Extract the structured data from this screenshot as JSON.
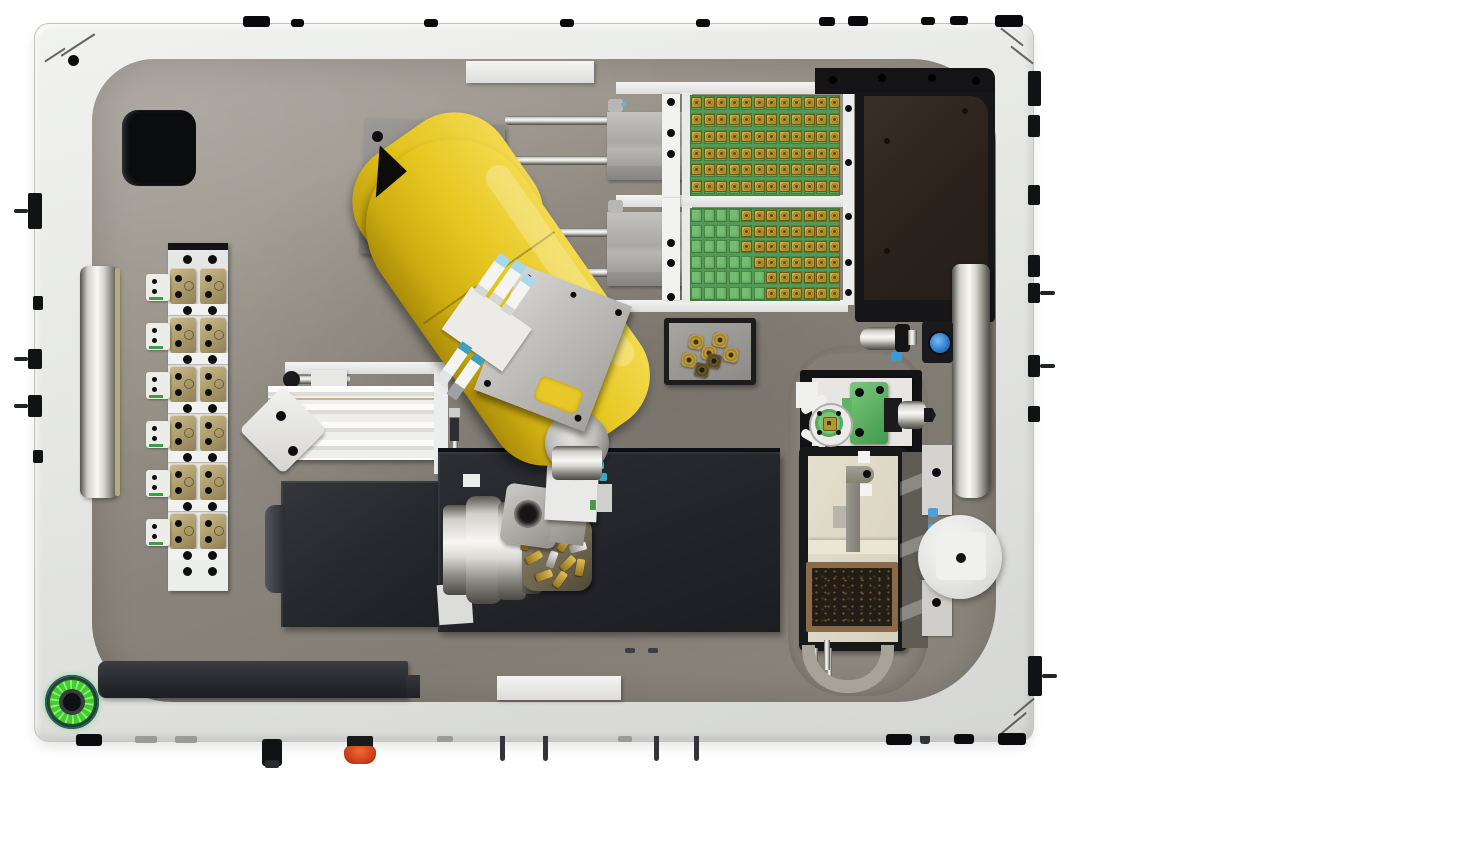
{
  "palette": {
    "background": "#ffffff",
    "frame": "#e9eae8",
    "deck": "#948f87",
    "deck_light": "#a7a29b",
    "deck_dark": "#7e7970",
    "robot_yellow": "#e6c41d",
    "robot_yellow_light": "#f4dc52",
    "robot_yellow_dark": "#b2930b",
    "tray_green": "#58a158",
    "tray_cell": "#74bd72",
    "chip_gold": "#c7a33e",
    "charcoal": "#26282c",
    "dark_brown": "#2f2620",
    "tan_module": "#b4a478",
    "cream": "#ded8c6",
    "chip_tray_frame": "#8a6a48",
    "chip_tray_fill": "#241d15",
    "led_green": "#4fd437",
    "estop_red": "#d2421f",
    "lens_blue": "#2e7fd0",
    "fitting_blue": "#58aee0",
    "green_fixture": "#5eb364"
  },
  "tool_rack": {
    "rows": 6,
    "columns": 2
  },
  "tray_feeders": {
    "columns": 12,
    "rows": 6,
    "trays": [
      {
        "id": "tray-1",
        "filled_per_row": [
          12,
          12,
          12,
          12,
          12,
          12
        ],
        "fill_align": "left"
      },
      {
        "id": "tray-2",
        "filled_per_row": [
          8,
          8,
          8,
          7,
          6,
          6
        ],
        "fill_align": "right"
      }
    ]
  },
  "parts_tray": {
    "nuts": [
      {
        "x": 20,
        "y": 12,
        "dark": false
      },
      {
        "x": 44,
        "y": 10,
        "dark": false
      },
      {
        "x": 33,
        "y": 23,
        "dark": false
      },
      {
        "x": 13,
        "y": 30,
        "dark": false
      },
      {
        "x": 38,
        "y": 31,
        "dark": true
      },
      {
        "x": 55,
        "y": 25,
        "dark": false
      },
      {
        "x": 26,
        "y": 40,
        "dark": true
      }
    ]
  },
  "tool_turret": {
    "bits": [
      {
        "dx": -20,
        "dy": -30,
        "rot": 40,
        "kind": "gold"
      },
      {
        "dx": 0,
        "dy": -32,
        "rot": 10,
        "kind": "gold"
      },
      {
        "dx": 16,
        "dy": -24,
        "rot": 65,
        "kind": "gold"
      },
      {
        "dx": -30,
        "dy": -12,
        "rot": 15,
        "kind": "gold"
      },
      {
        "dx": -10,
        "dy": -14,
        "rot": 50,
        "kind": "gold"
      },
      {
        "dx": 8,
        "dy": -10,
        "rot": 30,
        "kind": "gold"
      },
      {
        "dx": 22,
        "dy": -6,
        "rot": 75,
        "kind": "silver"
      },
      {
        "dx": -22,
        "dy": 4,
        "rot": 60,
        "kind": "gold"
      },
      {
        "dx": -4,
        "dy": 6,
        "rot": 20,
        "kind": "silver"
      },
      {
        "dx": 12,
        "dy": 10,
        "rot": 45,
        "kind": "gold"
      },
      {
        "dx": 24,
        "dy": 14,
        "rot": 10,
        "kind": "gold"
      },
      {
        "dx": -12,
        "dy": 22,
        "rot": 70,
        "kind": "gold"
      },
      {
        "dx": 4,
        "dy": 26,
        "rot": 35,
        "kind": "gold"
      }
    ]
  },
  "frame_hardware": {
    "top_screws": [
      [
        243,
        16,
        27,
        11
      ],
      [
        291,
        19,
        13,
        8
      ],
      [
        424,
        19,
        14,
        8
      ],
      [
        560,
        19,
        14,
        8
      ],
      [
        696,
        19,
        14,
        8
      ],
      [
        819,
        17,
        16,
        9
      ],
      [
        848,
        16,
        20,
        10
      ],
      [
        921,
        17,
        14,
        8
      ],
      [
        950,
        16,
        18,
        9
      ],
      [
        995,
        15,
        28,
        12
      ]
    ],
    "left_ports": [
      {
        "x": 28,
        "y": 193,
        "w": 14,
        "h": 36,
        "pin": true
      },
      {
        "x": 33,
        "y": 296,
        "w": 10,
        "h": 14,
        "pin": false
      },
      {
        "x": 28,
        "y": 349,
        "w": 14,
        "h": 20,
        "pin": true
      },
      {
        "x": 28,
        "y": 395,
        "w": 14,
        "h": 22,
        "pin": true
      },
      {
        "x": 33,
        "y": 450,
        "w": 10,
        "h": 13,
        "pin": false
      }
    ],
    "right_ports": [
      {
        "x": 1028,
        "y": 71,
        "w": 13,
        "h": 35,
        "pin": false
      },
      {
        "x": 1028,
        "y": 115,
        "w": 12,
        "h": 22,
        "pin": false
      },
      {
        "x": 1028,
        "y": 185,
        "w": 12,
        "h": 20,
        "pin": false
      },
      {
        "x": 1028,
        "y": 255,
        "w": 12,
        "h": 22,
        "pin": false
      },
      {
        "x": 1028,
        "y": 283,
        "w": 12,
        "h": 20,
        "pin": true
      },
      {
        "x": 1028,
        "y": 355,
        "w": 12,
        "h": 22,
        "pin": true
      },
      {
        "x": 1028,
        "y": 406,
        "w": 12,
        "h": 16,
        "pin": false
      },
      {
        "x": 1028,
        "y": 656,
        "w": 14,
        "h": 40,
        "pin": true
      }
    ],
    "bottom_feet": [
      [
        76,
        734,
        26,
        12
      ],
      [
        886,
        734,
        26,
        11
      ],
      [
        954,
        734,
        20,
        10
      ],
      [
        998,
        733,
        28,
        12
      ]
    ],
    "bottom_tabs": [
      [
        135,
        736,
        22,
        7
      ],
      [
        175,
        736,
        22,
        7
      ],
      [
        437,
        736,
        16,
        6
      ],
      [
        618,
        736,
        14,
        6
      ]
    ],
    "bottom_pins": [
      [
        500,
        736,
        5,
        25
      ],
      [
        543,
        736,
        5,
        25
      ],
      [
        654,
        736,
        5,
        25
      ],
      [
        694,
        736,
        5,
        25
      ],
      [
        920,
        736,
        10,
        8
      ]
    ],
    "bottom_connector": {
      "x": 262,
      "y": 739,
      "w": 20,
      "h": 27
    }
  },
  "feeder_rail_dots": {
    "carriage_1": [
      [
        671,
        102
      ],
      [
        671,
        133
      ],
      [
        671,
        154
      ]
    ],
    "carriage_2": [
      [
        671,
        243
      ],
      [
        671,
        263
      ],
      [
        671,
        297
      ]
    ],
    "right_rail": [
      [
        848,
        108
      ],
      [
        848,
        162
      ],
      [
        848,
        216
      ],
      [
        848,
        262
      ],
      [
        848,
        292
      ]
    ]
  }
}
